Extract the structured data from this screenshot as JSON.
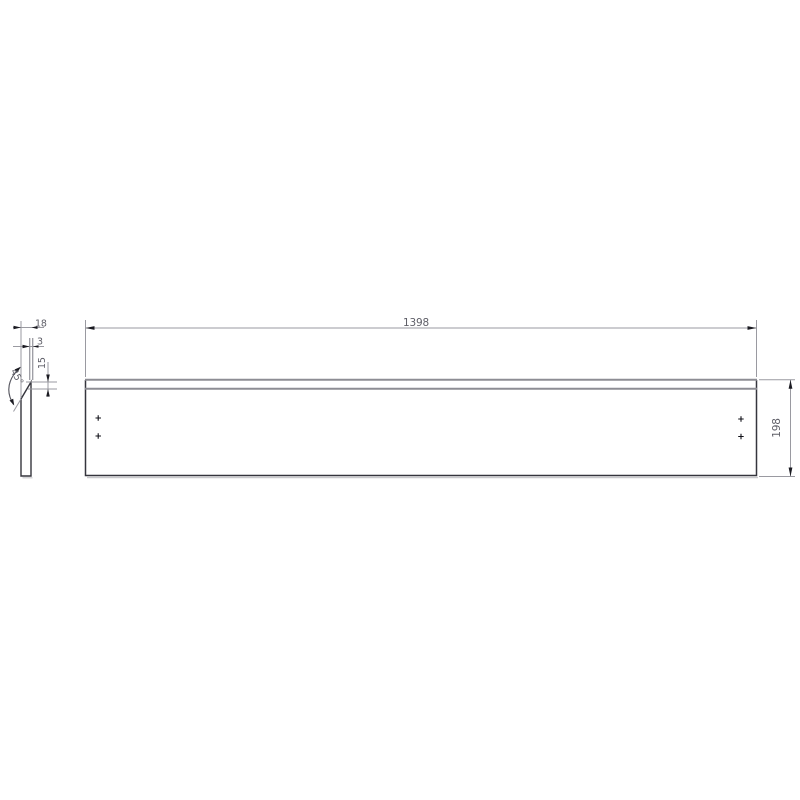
{
  "drawing": {
    "kind": "technical-dimension-drawing",
    "part": "long flat panel with 45-degree bent top flange",
    "dimensions": {
      "length": "1398",
      "height": "198",
      "flange_depth": "18",
      "thickness": "3",
      "flange_height": "15",
      "bend_angle": "45°"
    },
    "hole_markers": {
      "count": 4,
      "shape": "plus-cross",
      "layout": "two near left edge, two near right edge"
    },
    "colors": {
      "background": "#ffffff",
      "outline": "#35353d",
      "edge_gray": "#8d8d94",
      "dimension_line": "#9a9aa1",
      "arrow": "#1b1b22",
      "text": "#5f5f68",
      "shadow": "#c9c9cd"
    }
  }
}
